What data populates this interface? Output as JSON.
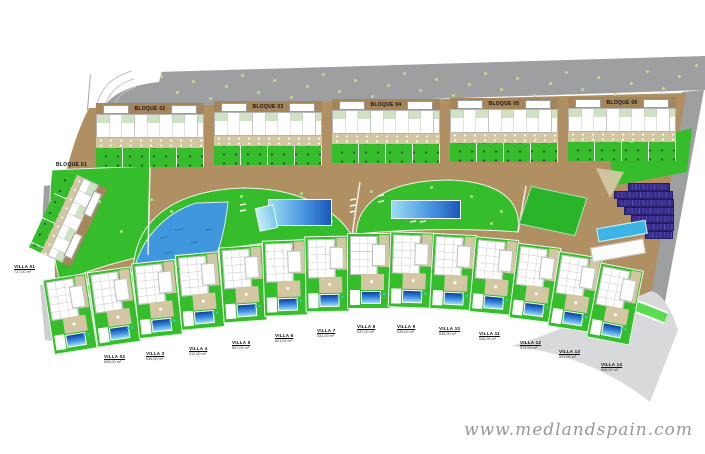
{
  "plan": {
    "title": "Residential master plan",
    "watermark": "www.medlandspain.com",
    "bloques": [
      {
        "label": "BLOQUE 01"
      },
      {
        "label": "BLOQUE 02"
      },
      {
        "label": "BLOQUE 03"
      },
      {
        "label": "BLOQUE 04"
      },
      {
        "label": "BLOQUE 05"
      },
      {
        "label": "BLOQUE 06"
      }
    ],
    "villas": [
      {
        "name": "VILLA 01",
        "area": "727,00 m²"
      },
      {
        "name": "VILLA 02",
        "area": "605,00 m²"
      },
      {
        "name": "VILLA 3",
        "area": "536,00 m²"
      },
      {
        "name": "VILLA 4",
        "area": "512,00 m²"
      },
      {
        "name": "VILLA 5",
        "area": "507,00 m²"
      },
      {
        "name": "VILLA 6",
        "area": "521,00 m²"
      },
      {
        "name": "VILLA 7",
        "area": "531,00 m²"
      },
      {
        "name": "VILLA 8",
        "area": "537,00 m²"
      },
      {
        "name": "VILLA 9",
        "area": "539,00 m²"
      },
      {
        "name": "VILLA 10",
        "area": "538,00 m²"
      },
      {
        "name": "VILLA 11",
        "area": "536,00 m²"
      },
      {
        "name": "VILLA 12",
        "area": "574,00 m²"
      },
      {
        "name": "VILLA 13",
        "area": "591,00 m²"
      },
      {
        "name": "VILLA 14",
        "area": "608,00 m²"
      }
    ],
    "amenities": {
      "lake": "lake-pool",
      "pool_a": "community-pool-west",
      "pool_b": "community-pool-central",
      "sports_field": "sports-field",
      "solar_array": "solar-panel-array",
      "lap_pool": "lap-pool",
      "court": "court-terrace"
    },
    "colors": {
      "road_gray": "#9d9fa1",
      "light_gray": "#ccced0",
      "land_brown": "#b08f63",
      "lawn_green": "#35bd2b",
      "path_green": "#57dd4d",
      "pale_green": "#cfe3c4",
      "terrace_beige": "#d2c7a2",
      "lake_blue": "#3f97dd",
      "pool_light": "#9bdcf2",
      "pool_dark": "#1b57b8",
      "solar_navy": "#372c8c",
      "cyan_pool": "#3db4e6"
    }
  }
}
